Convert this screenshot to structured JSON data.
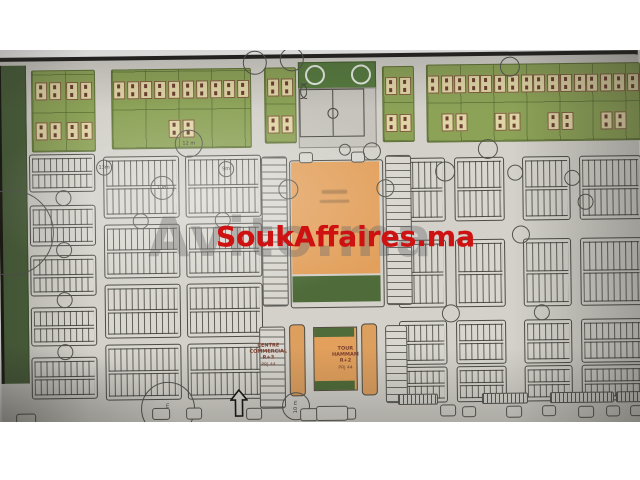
{
  "watermarks": {
    "primary": {
      "text": "SoukAffaires.ma",
      "color": "#ce1111"
    },
    "secondary": {
      "text": "Avito.ma",
      "color": "rgba(105,105,105,0.38)"
    }
  },
  "labels": {
    "centre_commercial": {
      "line1": "CENTRE",
      "line2": "COMMERCIAL R+3",
      "line3": "PRJ 44"
    },
    "tour_hammam": {
      "line1": "TOUR",
      "line2": "HAMMAM R+2",
      "line3": "PRJ 44"
    }
  },
  "road_width_labels": [
    "12 m",
    "13m",
    "10m",
    "9m",
    "30 m",
    "10 m"
  ],
  "colors": {
    "paper": "#d3d1ca",
    "edge": "#22211f",
    "villa_green": "#8ca257",
    "plot_beige": "#e0d5a6",
    "stadium_green": "#567a3f",
    "pitch_gray": "#c6c4bd",
    "souk_orange": "#e2a05c",
    "hammam_green": "#4e6b39",
    "line": "#4c4b45",
    "belt_green": "#49603a"
  },
  "map_features": {
    "green_belt": {
      "x": 0,
      "y": 4,
      "w": 24,
      "h": 318
    },
    "villa_blocks": [
      {
        "x": 33,
        "y": 9,
        "w": 62,
        "h": 80,
        "cols": 2,
        "rows": 2
      },
      {
        "x": 113,
        "y": 9,
        "w": 138,
        "h": 78,
        "cols": 3,
        "rows": 2
      },
      {
        "x": 266,
        "y": 9,
        "w": 30,
        "h": 74,
        "cols": 1,
        "rows": 2
      },
      {
        "x": 384,
        "y": 9,
        "w": 30,
        "h": 74,
        "cols": 1,
        "rows": 2
      },
      {
        "x": 428,
        "y": 8,
        "w": 212,
        "h": 76,
        "cols": 6,
        "rows": 2
      }
    ],
    "stadium": {
      "green": [
        300,
        4,
        76,
        26
      ],
      "pitch": [
        300,
        30,
        76,
        58
      ]
    },
    "parcel_blocks": [
      {
        "x": 30,
        "y": 93,
        "w": 64,
        "h": 36
      },
      {
        "x": 30,
        "y": 144,
        "w": 64,
        "h": 39
      },
      {
        "x": 30,
        "y": 194,
        "w": 64,
        "h": 39
      },
      {
        "x": 30,
        "y": 246,
        "w": 64,
        "h": 37
      },
      {
        "x": 30,
        "y": 296,
        "w": 64,
        "h": 40
      },
      {
        "x": 104,
        "y": 96,
        "w": 74,
        "h": 60
      },
      {
        "x": 104,
        "y": 164,
        "w": 74,
        "h": 52
      },
      {
        "x": 104,
        "y": 224,
        "w": 74,
        "h": 52
      },
      {
        "x": 104,
        "y": 284,
        "w": 74,
        "h": 54
      },
      {
        "x": 186,
        "y": 96,
        "w": 74,
        "h": 60
      },
      {
        "x": 186,
        "y": 164,
        "w": 74,
        "h": 52
      },
      {
        "x": 186,
        "y": 224,
        "w": 74,
        "h": 52
      },
      {
        "x": 186,
        "y": 284,
        "w": 74,
        "h": 54
      },
      {
        "x": 398,
        "y": 101,
        "w": 46,
        "h": 62
      },
      {
        "x": 455,
        "y": 101,
        "w": 48,
        "h": 62
      },
      {
        "x": 523,
        "y": 101,
        "w": 46,
        "h": 62
      },
      {
        "x": 580,
        "y": 101,
        "w": 60,
        "h": 62
      },
      {
        "x": 398,
        "y": 183,
        "w": 46,
        "h": 66
      },
      {
        "x": 455,
        "y": 183,
        "w": 48,
        "h": 66
      },
      {
        "x": 523,
        "y": 183,
        "w": 46,
        "h": 66
      },
      {
        "x": 580,
        "y": 183,
        "w": 60,
        "h": 66
      },
      {
        "x": 398,
        "y": 264,
        "w": 46,
        "h": 42
      },
      {
        "x": 455,
        "y": 264,
        "w": 48,
        "h": 42
      },
      {
        "x": 523,
        "y": 264,
        "w": 46,
        "h": 42
      },
      {
        "x": 580,
        "y": 264,
        "w": 60,
        "h": 42
      },
      {
        "x": 398,
        "y": 310,
        "w": 46,
        "h": 34
      },
      {
        "x": 455,
        "y": 310,
        "w": 48,
        "h": 34
      },
      {
        "x": 523,
        "y": 310,
        "w": 46,
        "h": 34
      },
      {
        "x": 580,
        "y": 310,
        "w": 60,
        "h": 34
      }
    ],
    "ladders": [
      {
        "x": 262,
        "y": 98,
        "w": 24,
        "h": 148
      },
      {
        "x": 386,
        "y": 98,
        "w": 24,
        "h": 148
      },
      {
        "x": 258,
        "y": 268,
        "w": 24,
        "h": 80
      },
      {
        "x": 384,
        "y": 268,
        "w": 20,
        "h": 76
      }
    ],
    "souk": {
      "border": [
        290,
        102,
        92,
        146
      ],
      "orange": [
        292,
        104,
        88,
        112
      ],
      "green": [
        292,
        218,
        88,
        26
      ],
      "tabs": [
        [
          300,
          94,
          12,
          9
        ],
        [
          352,
          94,
          12,
          9
        ]
      ],
      "smudges": [
        [
          322,
          132,
          26,
          4
        ],
        [
          320,
          142,
          30,
          3
        ]
      ]
    },
    "commercial": {
      "left_bar": [
        288,
        266,
        14,
        70
      ],
      "right_bar": [
        360,
        266,
        14,
        70
      ],
      "hammam": [
        312,
        269,
        42,
        62
      ],
      "left_label_box": [
        246,
        284,
        42
      ],
      "right_label_box": [
        324,
        288,
        40
      ]
    },
    "circles": [
      {
        "x": 189,
        "y": 83,
        "r": 13,
        "label": "12 m"
      },
      {
        "x": 104,
        "y": 106,
        "r": 7,
        "label": "13m"
      },
      {
        "x": 162,
        "y": 127,
        "r": 11,
        "label": "10m"
      },
      {
        "x": 226,
        "y": 109,
        "r": 7,
        "label": "9m"
      },
      {
        "x": 63,
        "y": 136,
        "r": 7
      },
      {
        "x": 63,
        "y": 188,
        "r": 7
      },
      {
        "x": 63,
        "y": 238,
        "r": 7
      },
      {
        "x": 63,
        "y": 290,
        "r": 7
      },
      {
        "x": 140,
        "y": 160,
        "r": 7
      },
      {
        "x": 222,
        "y": 160,
        "r": 7
      },
      {
        "x": 256,
        "y": 3,
        "r": 11
      },
      {
        "x": 293,
        "y": 0,
        "r": 11
      },
      {
        "x": 511,
        "y": 10,
        "r": 9
      },
      {
        "x": 372,
        "y": 93,
        "r": 8
      },
      {
        "x": 288,
        "y": 130,
        "r": 9
      },
      {
        "x": 385,
        "y": 130,
        "r": 8
      },
      {
        "x": 345,
        "y": 91,
        "r": 5
      },
      {
        "x": 445,
        "y": 114,
        "r": 9
      },
      {
        "x": 515,
        "y": 116,
        "r": 7
      },
      {
        "x": 572,
        "y": 122,
        "r": 7
      },
      {
        "x": 488,
        "y": 92,
        "r": 9
      },
      {
        "x": 520,
        "y": 178,
        "r": 8
      },
      {
        "x": 585,
        "y": 146,
        "r": 7
      },
      {
        "x": 449,
        "y": 256,
        "r": 8
      },
      {
        "x": 540,
        "y": 256,
        "r": 7
      },
      {
        "x": 10,
        "y": 170,
        "r": 42
      },
      {
        "x": 165,
        "y": 348,
        "r": 26,
        "label": "30 m",
        "vertical": true
      },
      {
        "x": 293,
        "y": 347,
        "r": 13,
        "label": "10 m",
        "vertical": true
      }
    ],
    "tabs": [
      {
        "x": 14,
        "y": 352,
        "w": 18,
        "h": 12
      },
      {
        "x": 150,
        "y": 348,
        "w": 16,
        "h": 10
      },
      {
        "x": 184,
        "y": 348,
        "w": 14,
        "h": 10
      },
      {
        "x": 244,
        "y": 349,
        "w": 14,
        "h": 10
      },
      {
        "x": 298,
        "y": 350,
        "w": 16,
        "h": 11
      },
      {
        "x": 338,
        "y": 350,
        "w": 14,
        "h": 10
      },
      {
        "x": 438,
        "y": 348,
        "w": 14,
        "h": 10
      },
      {
        "x": 460,
        "y": 350,
        "w": 12,
        "h": 9
      },
      {
        "x": 504,
        "y": 350,
        "w": 14,
        "h": 10
      },
      {
        "x": 540,
        "y": 350,
        "w": 12,
        "h": 9
      },
      {
        "x": 576,
        "y": 351,
        "w": 14,
        "h": 10
      },
      {
        "x": 604,
        "y": 351,
        "w": 12,
        "h": 9
      },
      {
        "x": 628,
        "y": 351,
        "w": 12,
        "h": 9
      },
      {
        "x": 314,
        "y": 348,
        "w": 30,
        "h": 13
      }
    ],
    "hatch_bars": [
      {
        "x": 396,
        "y": 337,
        "w": 38,
        "h": 9
      },
      {
        "x": 480,
        "y": 337,
        "w": 44,
        "h": 9
      },
      {
        "x": 548,
        "y": 337,
        "w": 62,
        "h": 9
      },
      {
        "x": 614,
        "y": 337,
        "w": 26,
        "h": 9
      }
    ],
    "arrow": {
      "x": 228,
      "y": 330,
      "w": 18,
      "h": 28
    }
  }
}
